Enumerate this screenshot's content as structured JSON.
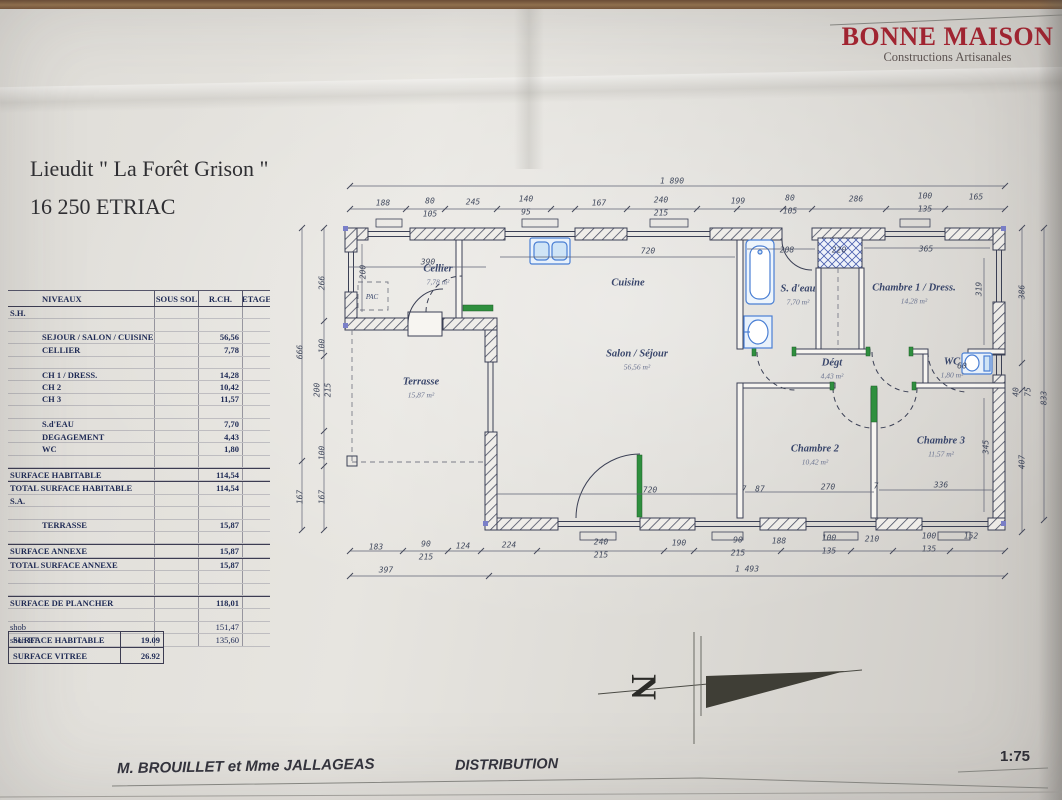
{
  "logo": {
    "title": "BONNE MAISON",
    "subtitle": "Constructions Artisanales",
    "color": "#a42431"
  },
  "title": {
    "line1": "Lieudit \" La Forêt Grison \"",
    "line2": "16 250 ETRIAC"
  },
  "surface_table": {
    "headers": [
      "NIVEAUX",
      "SOUS SOL",
      "R.CH.",
      "ETAGE"
    ],
    "rows": [
      {
        "kind": "section",
        "label": "S.H.",
        "sous_sol": "",
        "rch": "",
        "etage": ""
      },
      {
        "kind": "blank",
        "label": "",
        "sous_sol": "",
        "rch": "",
        "etage": ""
      },
      {
        "kind": "item",
        "label": "SEJOUR / SALON / CUISINE",
        "sous_sol": "",
        "rch": "56,56",
        "etage": ""
      },
      {
        "kind": "item",
        "label": "CELLIER",
        "sous_sol": "",
        "rch": "7,78",
        "etage": ""
      },
      {
        "kind": "blank",
        "label": "",
        "sous_sol": "",
        "rch": "",
        "etage": ""
      },
      {
        "kind": "item",
        "label": "CH 1 / DRESS.",
        "sous_sol": "",
        "rch": "14,28",
        "etage": ""
      },
      {
        "kind": "item",
        "label": "CH 2",
        "sous_sol": "",
        "rch": "10,42",
        "etage": ""
      },
      {
        "kind": "item",
        "label": "CH 3",
        "sous_sol": "",
        "rch": "11,57",
        "etage": ""
      },
      {
        "kind": "blank",
        "label": "",
        "sous_sol": "",
        "rch": "",
        "etage": ""
      },
      {
        "kind": "item",
        "label": "S.d'EAU",
        "sous_sol": "",
        "rch": "7,70",
        "etage": ""
      },
      {
        "kind": "item",
        "label": "DEGAGEMENT",
        "sous_sol": "",
        "rch": "4,43",
        "etage": ""
      },
      {
        "kind": "item",
        "label": "WC",
        "sous_sol": "",
        "rch": "1,80",
        "etage": ""
      },
      {
        "kind": "blank",
        "label": "",
        "sous_sol": "",
        "rch": "",
        "etage": ""
      },
      {
        "kind": "total",
        "label": "SURFACE HABITABLE",
        "sous_sol": "",
        "rch": "114,54",
        "etage": ""
      },
      {
        "kind": "total",
        "label": "TOTAL SURFACE HABITABLE",
        "sous_sol": "",
        "rch": "114,54",
        "etage": ""
      },
      {
        "kind": "section",
        "label": "S.A.",
        "sous_sol": "",
        "rch": "",
        "etage": ""
      },
      {
        "kind": "blank",
        "label": "",
        "sous_sol": "",
        "rch": "",
        "etage": ""
      },
      {
        "kind": "item",
        "label": "TERRASSE",
        "sous_sol": "",
        "rch": "15,87",
        "etage": ""
      },
      {
        "kind": "blank",
        "label": "",
        "sous_sol": "",
        "rch": "",
        "etage": ""
      },
      {
        "kind": "total",
        "label": "SURFACE ANNEXE",
        "sous_sol": "",
        "rch": "15,87",
        "etage": ""
      },
      {
        "kind": "total",
        "label": "TOTAL SURFACE ANNEXE",
        "sous_sol": "",
        "rch": "15,87",
        "etage": ""
      },
      {
        "kind": "blank",
        "label": "",
        "sous_sol": "",
        "rch": "",
        "etage": ""
      },
      {
        "kind": "blank",
        "label": "",
        "sous_sol": "",
        "rch": "",
        "etage": ""
      },
      {
        "kind": "total",
        "label": "SURFACE DE PLANCHER",
        "sous_sol": "",
        "rch": "118,01",
        "etage": ""
      },
      {
        "kind": "blank",
        "label": "",
        "sous_sol": "",
        "rch": "",
        "etage": ""
      },
      {
        "kind": "plain",
        "label": "shob",
        "sous_sol": "",
        "rch": "151,47",
        "etage": ""
      },
      {
        "kind": "plain",
        "label": "shon RT",
        "sous_sol": "",
        "rch": "135,60",
        "etage": ""
      }
    ]
  },
  "ratio_table": {
    "rows": [
      {
        "label": "SURFACE HABITABLE",
        "value": "19.09"
      },
      {
        "label": "SURFACE VITREE",
        "value": "26.92"
      }
    ]
  },
  "plan": {
    "north_label": "N",
    "rooms": [
      {
        "name": "Cellier",
        "area": "7,78 m²",
        "x": 438,
        "y": 269
      },
      {
        "name": "Cuisine",
        "area": "",
        "x": 628,
        "y": 283
      },
      {
        "name": "Salon / Séjour",
        "area": "56,56 m²",
        "x": 637,
        "y": 354
      },
      {
        "name": "Terrasse",
        "area": "15,87 m²",
        "x": 421,
        "y": 382
      },
      {
        "name": "S. d'eau",
        "area": "7,70 m²",
        "x": 798,
        "y": 289
      },
      {
        "name": "Chambre 1 / Dress.",
        "area": "14,28 m²",
        "x": 914,
        "y": 288
      },
      {
        "name": "Dégt",
        "area": "4,43 m²",
        "x": 832,
        "y": 363
      },
      {
        "name": "WC",
        "area": "1,80 m²",
        "x": 952,
        "y": 362
      },
      {
        "name": "Chambre 2",
        "area": "10,42 m²",
        "x": 815,
        "y": 449
      },
      {
        "name": "Chambre 3",
        "area": "11,57 m²",
        "x": 941,
        "y": 441
      },
      {
        "name": "PAC",
        "area": "",
        "x": 372,
        "y": 297,
        "small": true
      }
    ],
    "dims": {
      "totals": [
        {
          "t": "1 890",
          "x": 672,
          "y": 181
        },
        {
          "t": "397",
          "x": 386,
          "y": 570
        },
        {
          "t": "1 493",
          "x": 747,
          "y": 569
        }
      ],
      "top": [
        {
          "t": "188",
          "x": 383,
          "y": 203
        },
        {
          "t": "80",
          "x": 430,
          "y": 201
        },
        {
          "t": "105",
          "x": 430,
          "y": 214
        },
        {
          "t": "245",
          "x": 473,
          "y": 202
        },
        {
          "t": "140",
          "x": 526,
          "y": 199
        },
        {
          "t": "95",
          "x": 526,
          "y": 212
        },
        {
          "t": "167",
          "x": 599,
          "y": 203
        },
        {
          "t": "240",
          "x": 661,
          "y": 200
        },
        {
          "t": "215",
          "x": 661,
          "y": 213
        },
        {
          "t": "199",
          "x": 738,
          "y": 201
        },
        {
          "t": "80",
          "x": 790,
          "y": 198
        },
        {
          "t": "105",
          "x": 790,
          "y": 211
        },
        {
          "t": "286",
          "x": 856,
          "y": 199
        },
        {
          "t": "100",
          "x": 925,
          "y": 196
        },
        {
          "t": "135",
          "x": 925,
          "y": 209
        },
        {
          "t": "165",
          "x": 976,
          "y": 197
        }
      ],
      "bottom": [
        {
          "t": "183",
          "x": 376,
          "y": 547
        },
        {
          "t": "90",
          "x": 426,
          "y": 544
        },
        {
          "t": "215",
          "x": 426,
          "y": 557
        },
        {
          "t": "124",
          "x": 463,
          "y": 546
        },
        {
          "t": "224",
          "x": 509,
          "y": 545
        },
        {
          "t": "240",
          "x": 601,
          "y": 542
        },
        {
          "t": "215",
          "x": 601,
          "y": 555
        },
        {
          "t": "190",
          "x": 679,
          "y": 543
        },
        {
          "t": "90",
          "x": 738,
          "y": 540
        },
        {
          "t": "215",
          "x": 738,
          "y": 553
        },
        {
          "t": "188",
          "x": 779,
          "y": 541
        },
        {
          "t": "100",
          "x": 829,
          "y": 538
        },
        {
          "t": "135",
          "x": 829,
          "y": 551
        },
        {
          "t": "210",
          "x": 872,
          "y": 539
        },
        {
          "t": "100",
          "x": 929,
          "y": 536
        },
        {
          "t": "135",
          "x": 929,
          "y": 549
        },
        {
          "t": "152",
          "x": 971,
          "y": 536
        }
      ],
      "left": [
        {
          "t": "666",
          "x": 300,
          "y": 352,
          "rot": 1
        },
        {
          "t": "167",
          "x": 300,
          "y": 497,
          "rot": 1
        },
        {
          "t": "266",
          "x": 322,
          "y": 283,
          "rot": 1
        },
        {
          "t": "100",
          "x": 322,
          "y": 346,
          "rot": 1
        },
        {
          "t": "200",
          "x": 317,
          "y": 390,
          "rot": 1
        },
        {
          "t": "215",
          "x": 328,
          "y": 390,
          "rot": 1
        },
        {
          "t": "100",
          "x": 322,
          "y": 453,
          "rot": 1
        },
        {
          "t": "167",
          "x": 322,
          "y": 497,
          "rot": 1
        }
      ],
      "right": [
        {
          "t": "386",
          "x": 1022,
          "y": 292,
          "rot": 1
        },
        {
          "t": "40",
          "x": 1016,
          "y": 392,
          "rot": 1
        },
        {
          "t": "75",
          "x": 1028,
          "y": 392,
          "rot": 1
        },
        {
          "t": "407",
          "x": 1022,
          "y": 462,
          "rot": 1
        },
        {
          "t": "833",
          "x": 1044,
          "y": 398,
          "rot": 1
        },
        {
          "t": "319",
          "x": 979,
          "y": 289,
          "rot": 1
        },
        {
          "t": "345",
          "x": 986,
          "y": 447,
          "rot": 1
        }
      ],
      "interior": [
        {
          "t": "390",
          "x": 428,
          "y": 262
        },
        {
          "t": "200",
          "x": 363,
          "y": 272,
          "rot": 1
        },
        {
          "t": "720",
          "x": 648,
          "y": 251
        },
        {
          "t": "208",
          "x": 787,
          "y": 250
        },
        {
          "t": "220",
          "x": 839,
          "y": 250
        },
        {
          "t": "365",
          "x": 926,
          "y": 249
        },
        {
          "t": "720",
          "x": 650,
          "y": 490
        },
        {
          "t": "7",
          "x": 744,
          "y": 489
        },
        {
          "t": "87",
          "x": 760,
          "y": 489
        },
        {
          "t": "270",
          "x": 828,
          "y": 487
        },
        {
          "t": "7",
          "x": 876,
          "y": 486
        },
        {
          "t": "336",
          "x": 941,
          "y": 485
        },
        {
          "t": "60",
          "x": 962,
          "y": 366
        }
      ]
    }
  },
  "footer": {
    "client": "M. BROUILLET et Mme JALLAGEAS",
    "doc_title": "DISTRIBUTION",
    "scale": "1:75"
  }
}
